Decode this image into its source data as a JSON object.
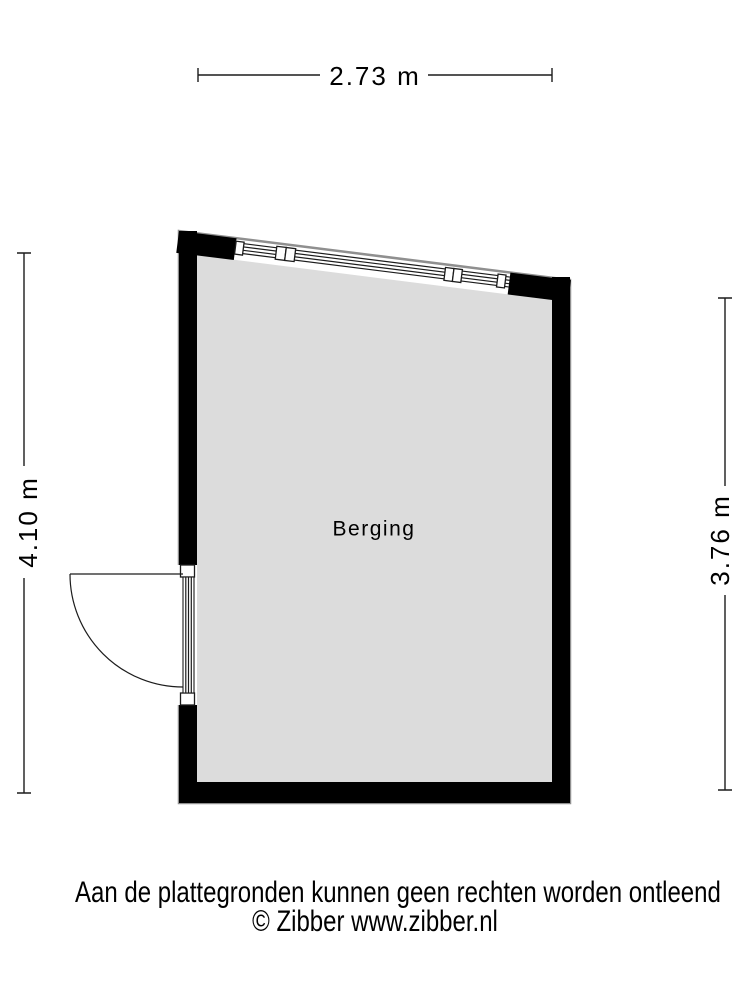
{
  "floorplan": {
    "room": {
      "label": "Berging"
    },
    "dimensions": {
      "top": "2.73 m",
      "left": "4.10 m",
      "right": "3.76 m"
    },
    "colors": {
      "wall": "#000000",
      "room_fill": "#dcdcdc",
      "outline_halo": "#8f8f8f",
      "line": "#1c1c1c",
      "background": "#ffffff",
      "text": "#000000"
    }
  },
  "footer": {
    "disclaimer": "Aan de plattegronden kunnen geen rechten worden ontleend",
    "copyright": "© Zibber www.zibber.nl"
  }
}
